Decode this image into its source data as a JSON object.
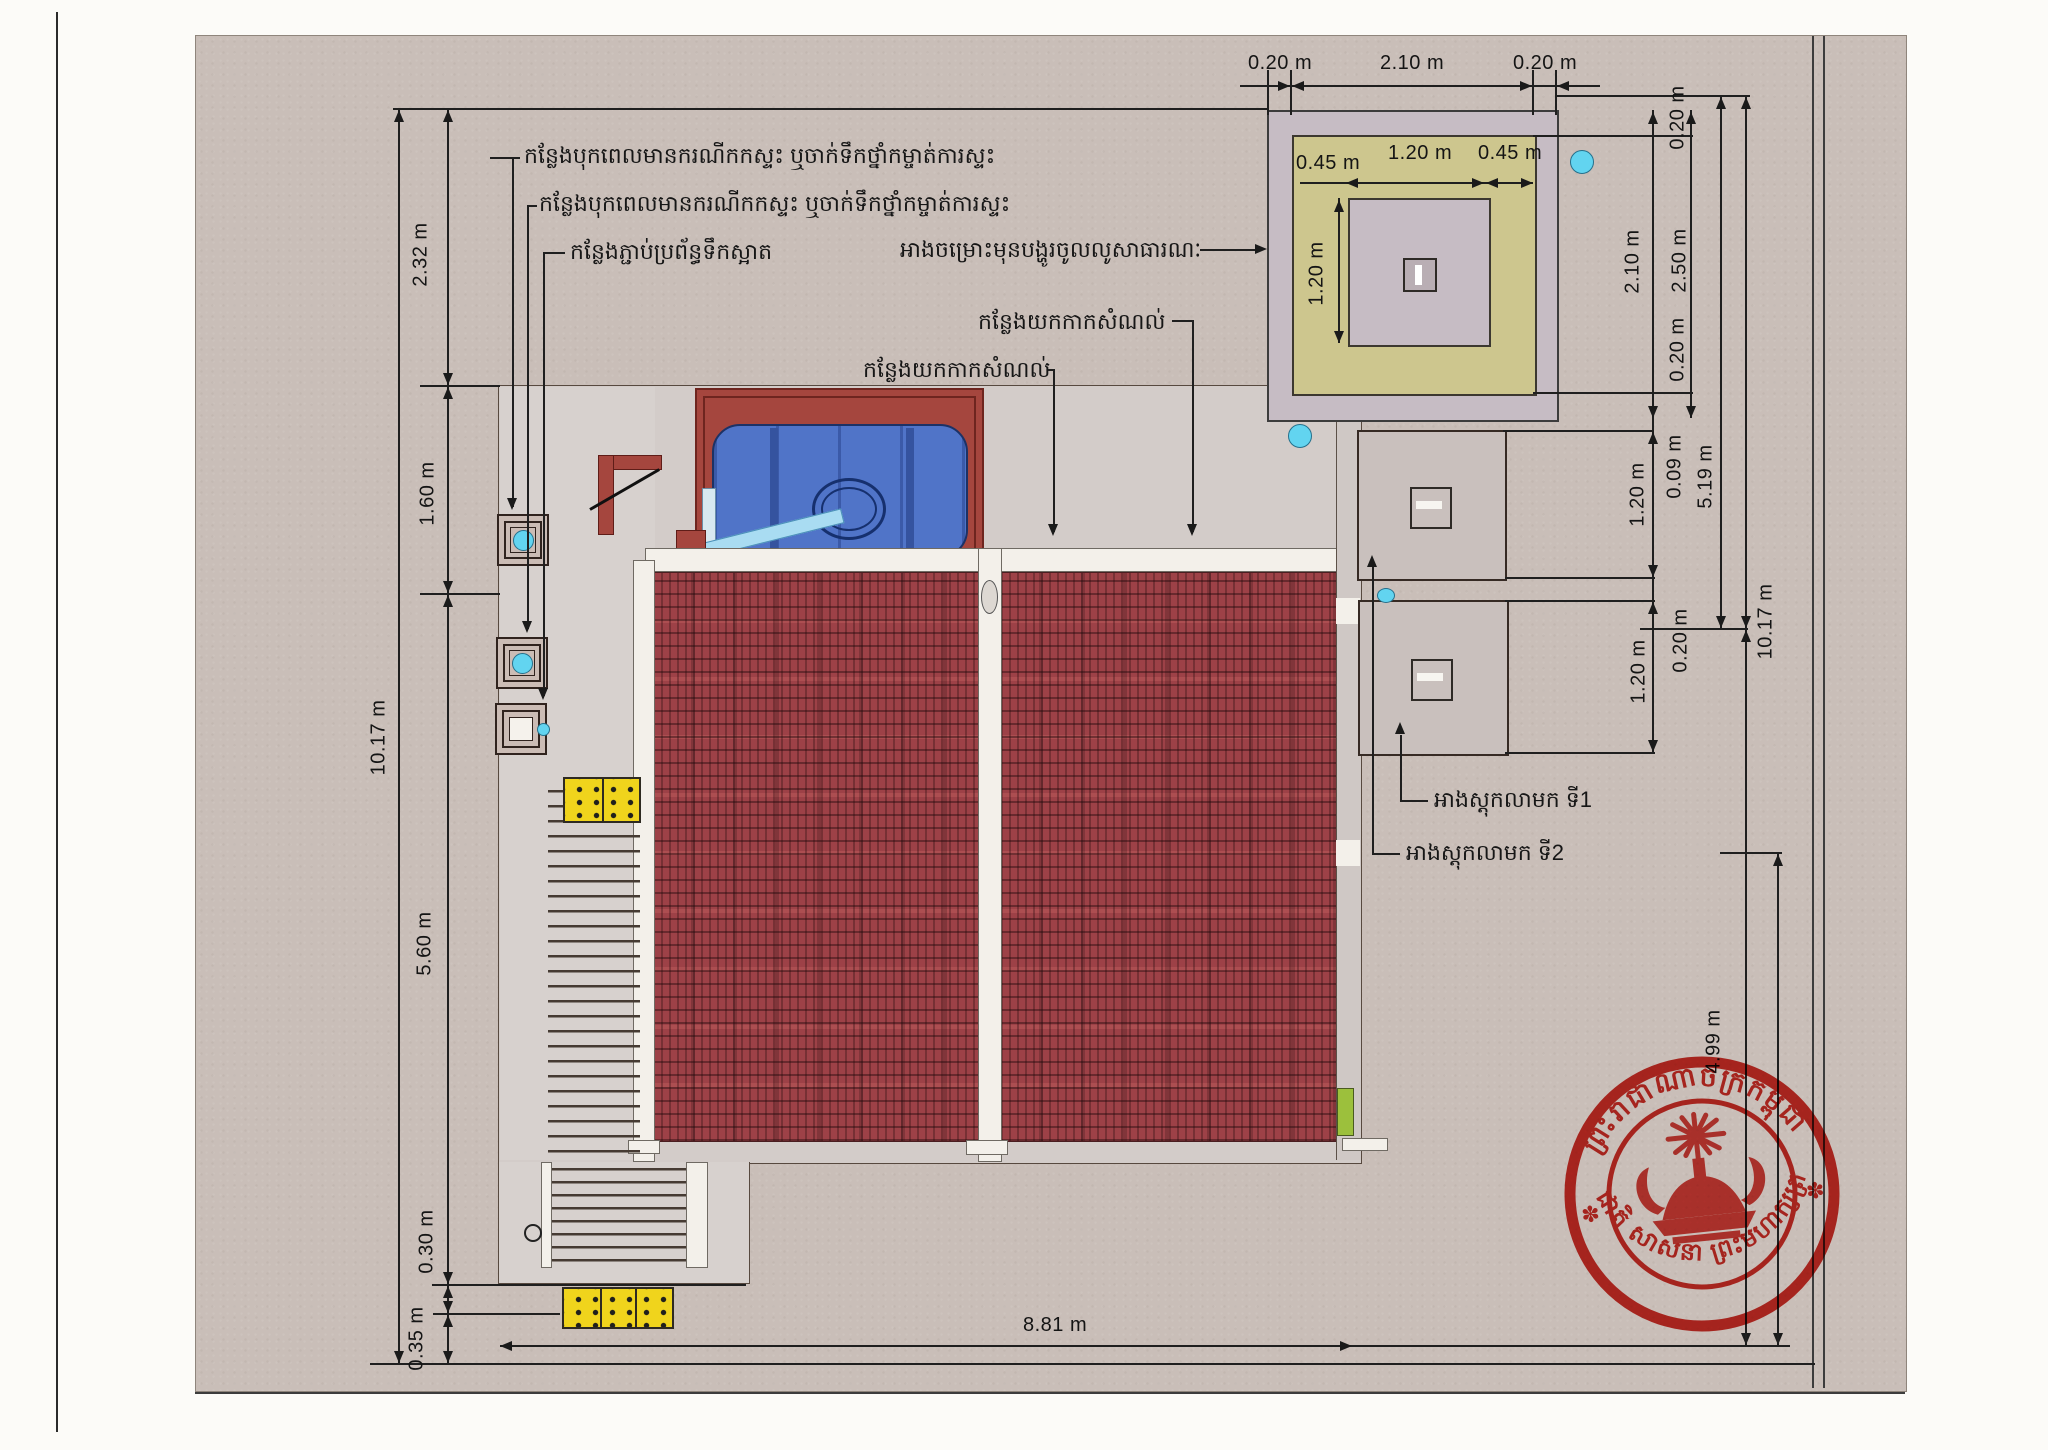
{
  "annotations": {
    "cleanout_1": "កន្លែងបុកពេលមានករណីកកស្ទះ ឬចាក់ទឹកថ្នាំកម្ចាត់ការស្ទះ",
    "cleanout_2": "កន្លែងបុកពេលមានករណីកកស្ទះ ឬចាក់ទឹកថ្នាំកម្ចាត់ការស្ទះ",
    "water_connection": "កន្លែងភ្ជាប់ប្រព័ន្ធទឹកស្អាត",
    "filter_tank": "អាងចម្រោះមុនបង្ហូរចូលលូសាធារណៈ",
    "debris_upper": "កន្លែងយកកាកសំណល់",
    "debris_lower": "កន្លែងយកកាកសំណល់",
    "septic_1": "អាងស្តុកលាមក ទី1",
    "septic_2": "អាងស្តុកលាមក ទី2"
  },
  "dimensions": {
    "d232": "2.32 m",
    "d160": "1.60 m",
    "d1017_left": "10.17 m",
    "d560": "5.60 m",
    "d030": "0.30 m",
    "d035": "0.35 m",
    "d881": "8.81 m",
    "top_left_020": "0.20 m",
    "top_210": "2.10 m",
    "top_right_020": "0.20 m",
    "inner_left_045": "0.45 m",
    "inner_120": "1.20 m",
    "inner_right_045": "0.45 m",
    "det_v120": "1.20 m",
    "right_020_top": "0.20 m",
    "right_210": "2.10 m",
    "right_250": "2.50 m",
    "right_020_bottom": "0.20 m",
    "right_009": "0.09 m",
    "right_519": "5.19 m",
    "tank1_120": "1.20 m",
    "gap_020": "0.20 m",
    "tank2_120": "1.20 m",
    "right_1017": "10.17 m",
    "right_499": "4.99 m"
  },
  "stamp": {
    "top_text": "ព្រះរាជាណាចក្រកម្ពុជា",
    "bottom_text": "ជាតិ សាសនា ព្រះមហាក្សត្រ",
    "rosette": "✽"
  },
  "colors": {
    "site_gray": "#c9beb8",
    "roof_red": "#9d4147",
    "platform_red": "#a5463e",
    "tank_blue": "#5074c8",
    "pipe_blue": "#a9dcf2",
    "footing_olive": "#cdc68e",
    "wall_band": "#c6bcc4",
    "mat_yellow": "#f0d41c",
    "grass_green": "#9cc03c",
    "drain_cyan": "#62d4f0",
    "stamp_red": "#cf2018"
  }
}
